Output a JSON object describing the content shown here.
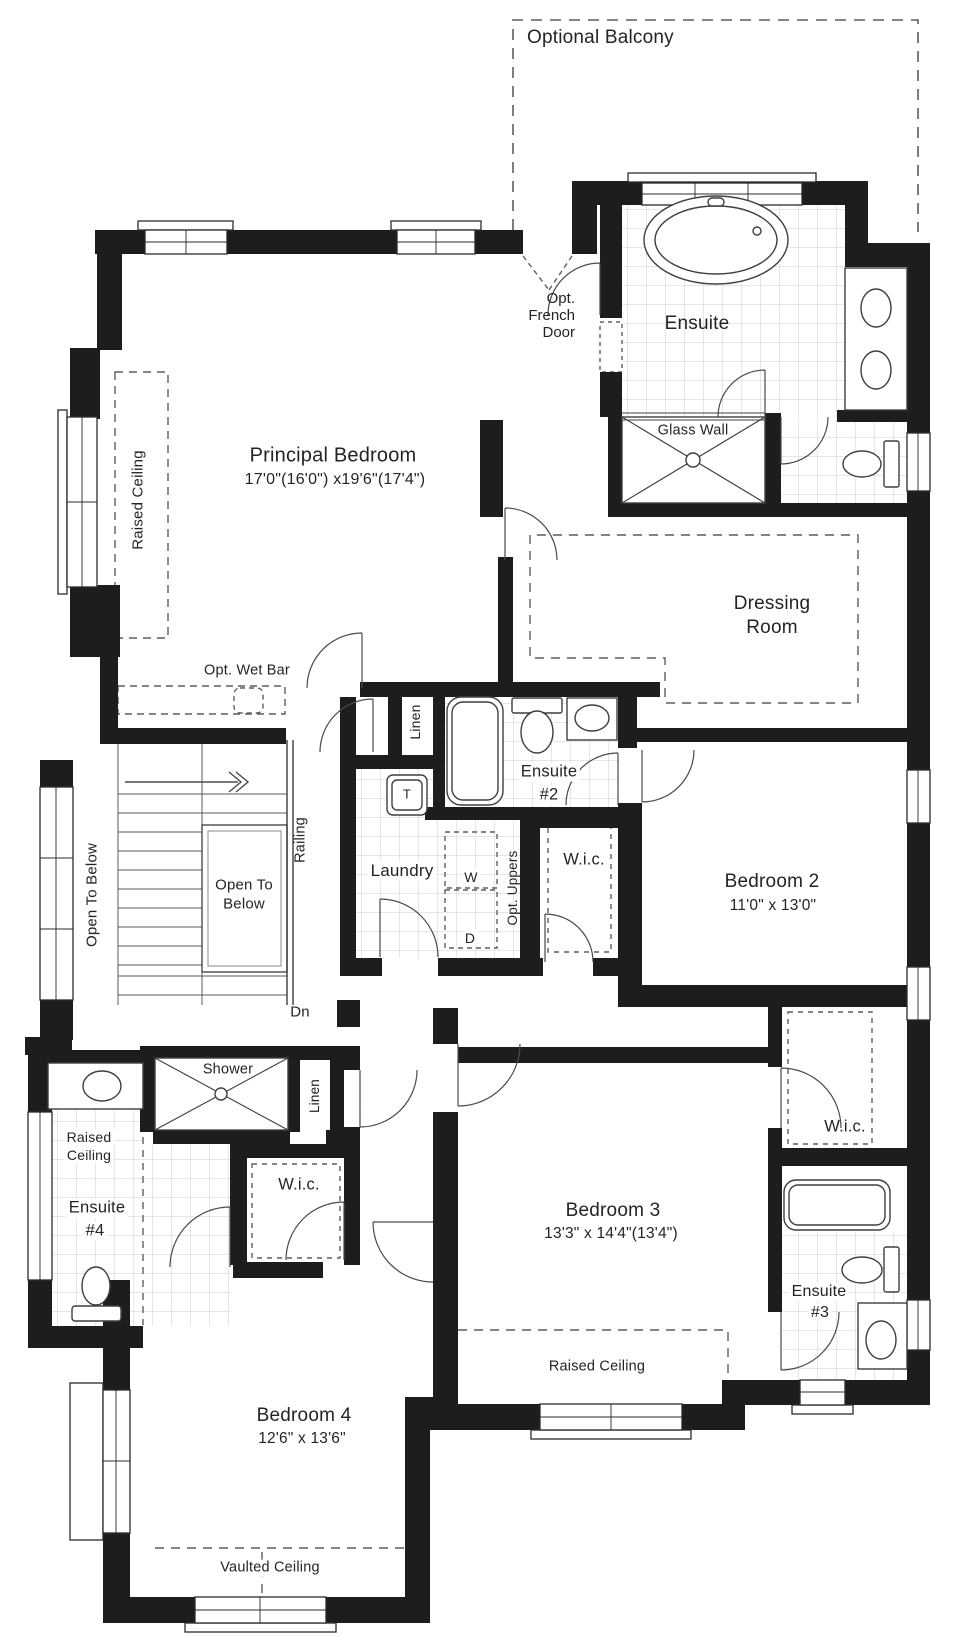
{
  "balcony": {
    "label": "Optional Balcony"
  },
  "principal_suite": {
    "bedroom": {
      "name": "Principal Bedroom",
      "dims": "17'0\"(16'0\") x19'6\"(17'4\")"
    },
    "raised_ceiling": "Raised Ceiling",
    "wet_bar": "Opt. Wet Bar",
    "french_door": {
      "line1": "Opt.",
      "line2": "French",
      "line3": "Door"
    },
    "ensuite": {
      "name": "Ensuite",
      "glass_wall": "Glass Wall"
    },
    "dressing_room": {
      "line1": "Dressing",
      "line2": "Room"
    }
  },
  "stairs": {
    "open_to_below_side": "Open To Below",
    "open_to_below": {
      "line1": "Open To",
      "line2": "Below"
    },
    "railing": "Railing",
    "down": "Dn"
  },
  "hall": {
    "linen_upper": "Linen",
    "linen_lower": "Linen",
    "shower": "Shower"
  },
  "laundry": {
    "name": "Laundry",
    "tub": "T",
    "washer": "W",
    "dryer": "D",
    "uppers": "Opt. Uppers"
  },
  "bedroom2": {
    "name": "Bedroom 2",
    "dims": "11'0\" x 13'0\"",
    "wic": "W.i.c.",
    "ensuite": {
      "line1": "Ensuite",
      "line2": "#2"
    }
  },
  "bedroom3": {
    "name": "Bedroom 3",
    "dims": "13'3\" x 14'4\"(13'4\")",
    "wic": "W.i.c.",
    "ensuite": {
      "line1": "Ensuite",
      "line2": "#3"
    },
    "raised_ceiling": "Raised Ceiling"
  },
  "bedroom4": {
    "name": "Bedroom 4",
    "dims": "12'6\" x 13'6\"",
    "wic": "W.i.c.",
    "ensuite": {
      "line1": "Ensuite",
      "line2": "#4"
    },
    "ensuite_raised_ceiling": {
      "line1": "Raised",
      "line2": "Ceiling"
    },
    "vaulted_ceiling": "Vaulted Ceiling"
  }
}
